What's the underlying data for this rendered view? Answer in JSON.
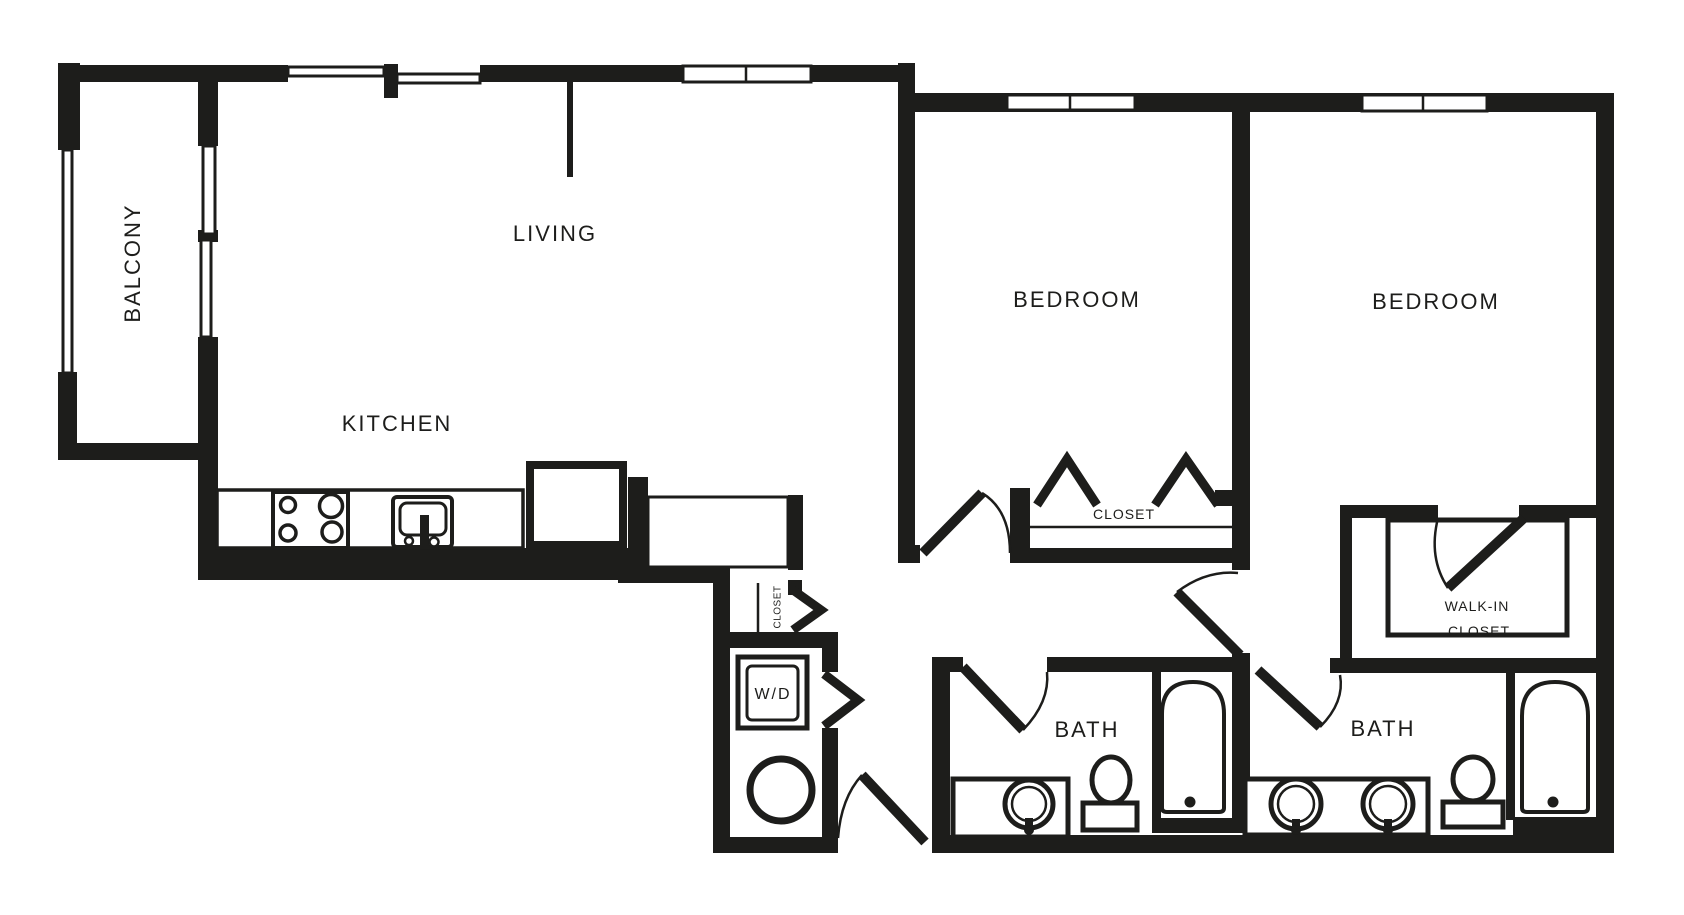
{
  "meta": {
    "drawing_type": "apartment floor plan",
    "background_color": "#ffffff",
    "wall_color": "#1d1d1b"
  },
  "labels": {
    "balcony": "BALCONY",
    "living": "LIVING",
    "kitchen": "KITCHEN",
    "bedroom1": "BEDROOM",
    "bedroom2": "BEDROOM",
    "closet1": "CLOSET",
    "hall_closet": "CLOSET",
    "walk_in_line1": "WALK-IN",
    "walk_in_line2": "CLOSET",
    "bath1": "BATH",
    "bath2": "BATH",
    "washer_dryer": "W/D"
  },
  "fixture_icons": [
    "stove-icon",
    "kitchen-sink-icon",
    "refrigerator-icon",
    "peninsula-counter",
    "washer-dryer-box",
    "water-heater-icon",
    "closet-rod",
    "closet-shelf-line",
    "bifold-door-icon",
    "door-swing-arc",
    "vanity-sink-icon",
    "toilet-icon",
    "bathtub-icon",
    "window"
  ]
}
